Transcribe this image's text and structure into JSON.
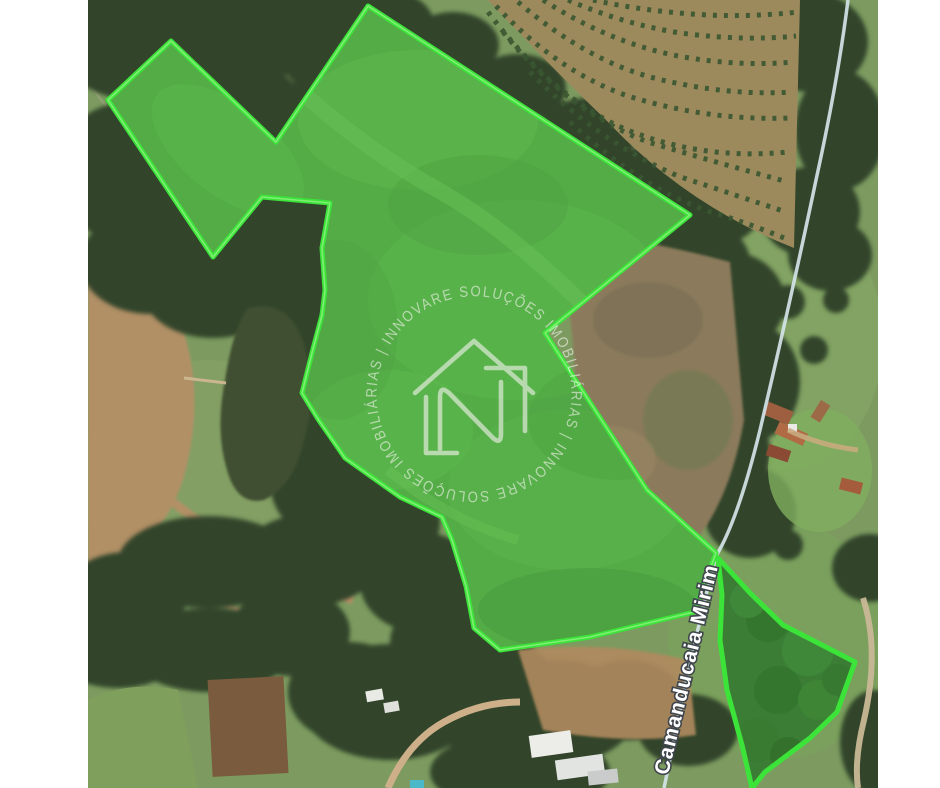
{
  "map": {
    "road_label": "Camanducaia Mirim",
    "watermark": {
      "brand": "INNOVARE SOLUÇÕES IMOBILIÁRIAS",
      "ring_text": "INNOVARE SOLUÇÕES IMOBILIÁRIAS | INNOVARE SOLUÇÕES IMOBILIÁRIAS |",
      "logo": "innovare-house-n-logo",
      "color": "#f2f2ec"
    },
    "overlay": {
      "stroke_color": "#3ce43a",
      "stroke_highlight": "#97f287",
      "fill_tint": "rgba(96,233,76,0.30)",
      "main_parcel_points": "280,6 602,215 457,333 559,490 628,553 606,612 502,637 412,650 386,628 378,586 364,540 354,517 312,497 257,458 230,419 214,393 225,349 234,315 237,290 234,248 242,203 174,197 125,257 20,100 83,41 188,142",
      "secondary_parcel_points": "630,558 662,593 695,625 767,662 749,712 722,738 677,772 664,788 654,745 639,690 632,640 634,595"
    }
  }
}
